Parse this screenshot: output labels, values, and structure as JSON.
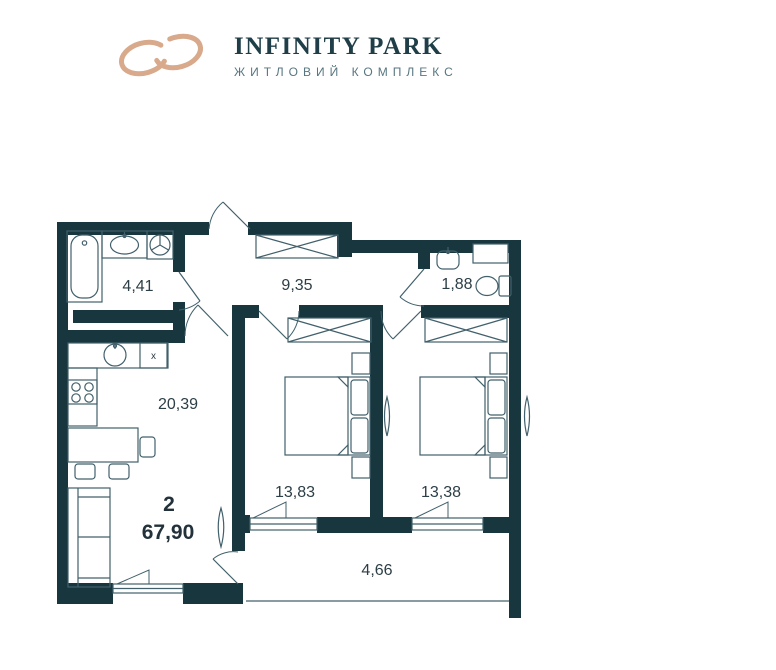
{
  "brand": {
    "name": "INFINITY PARK",
    "tagline": "ЖИТЛОВИЙ КОМПЛЕКС",
    "accent_color": "#d8a98b",
    "text_color": "#1f3e47"
  },
  "plan": {
    "wall_color": "#17363e",
    "line_color": "#41606b",
    "label_color": "#2c3e46",
    "rooms": {
      "bathroom": {
        "area": "4,41"
      },
      "hallway": {
        "area": "9,35"
      },
      "wc": {
        "area": "1,88"
      },
      "kitchen_living": {
        "area": "20,39"
      },
      "bedroom1": {
        "area": "13,83"
      },
      "bedroom2": {
        "area": "13,38"
      },
      "balcony": {
        "area": "4,66"
      }
    },
    "apartment": {
      "rooms_count": "2",
      "total_area": "67,90"
    },
    "marks": {
      "kitchen_unit": "x"
    }
  }
}
